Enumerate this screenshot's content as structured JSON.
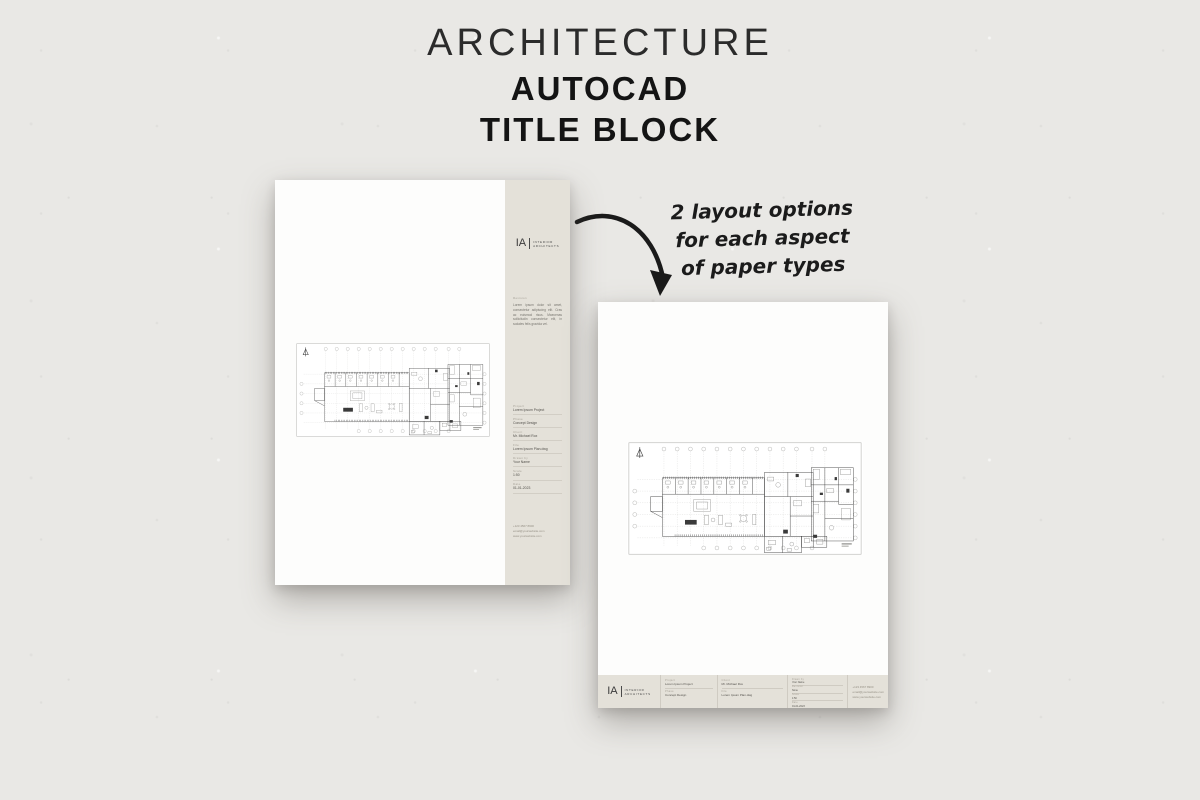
{
  "header": {
    "line1": "ARCHITECTURE",
    "line2": "AUTOCAD",
    "line3": "TITLE BLOCK"
  },
  "annotation": {
    "line1": "2 layout options",
    "line2": "for each aspect",
    "line3": "of paper types"
  },
  "brand": {
    "initials": "IA",
    "name_line1": "INTERIOR",
    "name_line2": "ARCHITECTS"
  },
  "titleblock": {
    "revision_label": "Revision",
    "revision_text": "Lorem ipsum dolor sit amet, consectetur adipiscing elit. Cras ac euismod risus. Maecenas sollicitudin consectetur elit, in sodales felis gravida vel.",
    "revision_value": "None",
    "fields": [
      {
        "label": "Project",
        "value": "Lorem Ipsum Project"
      },
      {
        "label": "Phase",
        "value": "Concept Design"
      },
      {
        "label": "Client",
        "value": "Mr. Michael Rox"
      },
      {
        "label": "File",
        "value": "Lorem Ipsum Plan.dwg"
      },
      {
        "label": "Drawn by",
        "value": "Your Name"
      },
      {
        "label": "Scale",
        "value": "1:50"
      },
      {
        "label": "Date",
        "value": "01-01-2023"
      }
    ],
    "contact": [
      "+123 4567 8900",
      "email@yourwebsite.com",
      "www.yourwebsite.com"
    ]
  }
}
